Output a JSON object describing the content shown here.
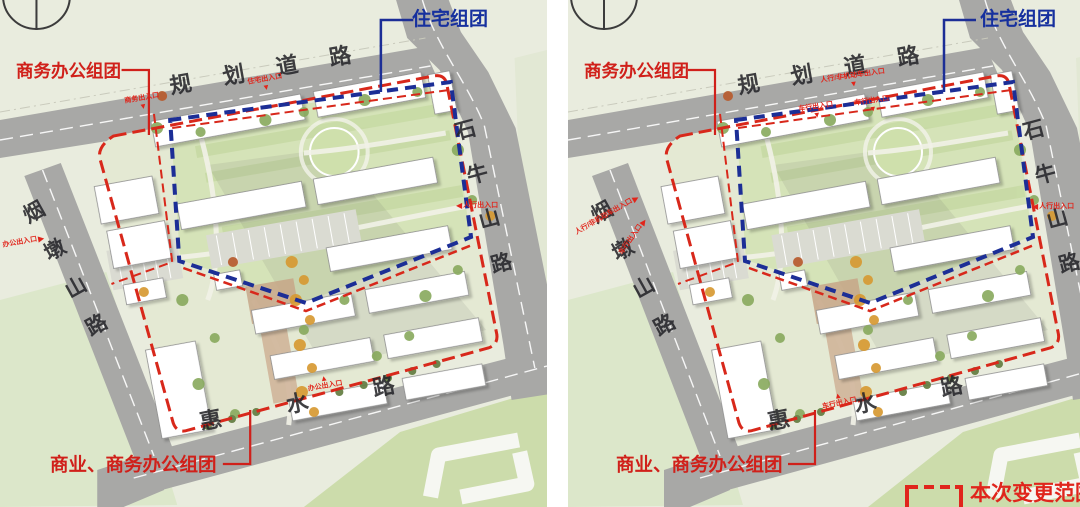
{
  "icons": {
    "arrow_down": "▼",
    "arrow_up": "▲",
    "arrow_left": "◀",
    "arrow_right": "▶"
  },
  "colors": {
    "boundary_red": "#d8281b",
    "boundary_blue": "#1c2e96",
    "label_red": "#d0201a",
    "label_blue": "#16309e",
    "road_gray": "#a8a8a6",
    "land_green": "#e9ecde"
  },
  "left_panel": {
    "callout_business_office": "商务办公组团",
    "callout_residential": "住宅组团",
    "callout_commercial_business": "商业、商务办公组团",
    "road_top": "规划道路",
    "road_right": "石牛山路",
    "road_left": "烟墩山路",
    "road_bottom": "惠水路",
    "entrances": {
      "top_left": "商务出入口",
      "top_center": "住宅出入口",
      "right": "人行出入口",
      "left": "办公出入口",
      "bottom": "办公出入口"
    }
  },
  "right_panel": {
    "callout_business_office": "商务办公组团",
    "callout_residential": "住宅组团",
    "callout_commercial_business": "商业、商务办公组团",
    "road_top": "规划道路",
    "road_right": "石牛山路",
    "road_left": "烟墩山路",
    "road_bottom": "惠水路",
    "entrances": {
      "top_center": "人行/非机动车出入口",
      "top_car_left": "车行出入口",
      "top_car_right": "车行出入口",
      "left": "人行/非机动车出入口",
      "left_car": "车行出入口",
      "right": "人行出入口",
      "bottom_car": "车行出入口"
    },
    "legend_label": "本次变更范围"
  }
}
